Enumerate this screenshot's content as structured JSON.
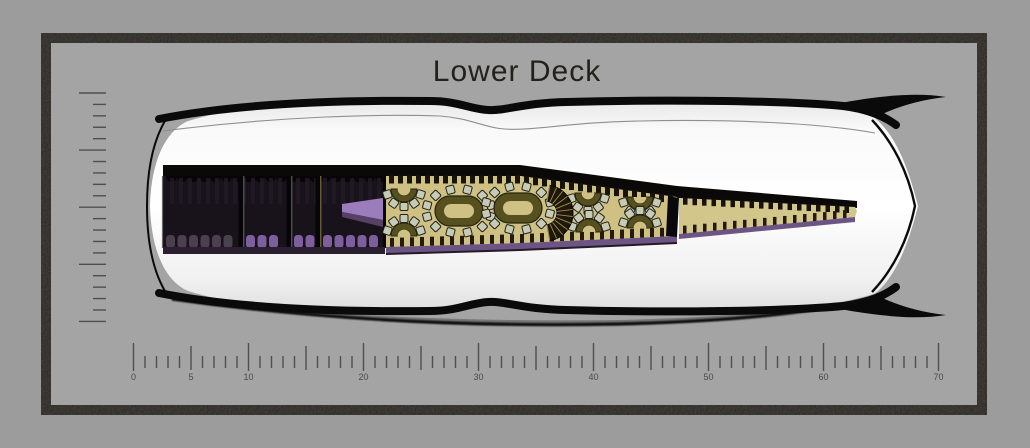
{
  "title": "Lower Deck",
  "colors": {
    "page_bg": "#9c9c9c",
    "mat_bg": "#a4a4a4",
    "frame": "#2b2724",
    "title_text": "#23211c",
    "ruler_tick": "#4f4f4f",
    "ruler_label": "#4a4a4a",
    "hull_edge": "#0a0a0a",
    "crease": "#8f8f8f",
    "hull_shadow": "#4a4a4a",
    "interior_dark": "#18121b",
    "interior_border": "#0b0908",
    "wall": "#060507",
    "wall_accent": "#8d8544",
    "wall_edge_light": "#6a6a6a",
    "floor_tan": "#cfc183",
    "floor_tan_bow": "#d2c68a",
    "tooth_dark": "#17120a",
    "rib_dark": "#241a10",
    "curtain_streak": "#231a26",
    "scallop_dark": "#070508",
    "seat_gray": "#4a4050",
    "seat_purple": "#7d5f9e",
    "band_purple": "#6d5583",
    "under_shadow": "#241a29",
    "rooms_underline": "#2a2030",
    "wedge_purple": "#9b7cbc",
    "wedge_shadow": "#573f66",
    "table_ring": "#55501e",
    "table_edge": "#26230e",
    "table_center": "#cfc183",
    "chair": "#c6cbb5",
    "chair_edge": "#23211a",
    "fan_dark": "#1f1806",
    "fan_spoke": "#c5b572",
    "bulkhead": "#0a080c"
  },
  "rulers": {
    "horizontal": {
      "min": 0,
      "max": 70,
      "origin_x": 133.5,
      "px_per_unit": 11.5,
      "minor_step": 1,
      "medium_step": 5,
      "major_step": 10,
      "labels": [
        {
          "unit": 0,
          "text": "0"
        },
        {
          "unit": 5,
          "text": "5"
        },
        {
          "unit": 10,
          "text": "10"
        },
        {
          "unit": 20,
          "text": "20"
        },
        {
          "unit": 30,
          "text": "30"
        },
        {
          "unit": 40,
          "text": "40"
        },
        {
          "unit": 50,
          "text": "50"
        },
        {
          "unit": 60,
          "text": "60"
        },
        {
          "unit": 70,
          "text": "70"
        }
      ]
    },
    "vertical": {
      "ticks": 21,
      "major_every": 5,
      "x_right": 106,
      "major_len": 27,
      "minor_len": 13,
      "y_top": 93,
      "step": 11.42
    }
  },
  "deck_plan": {
    "rooms": {
      "bounds": [
        163,
        176,
        385,
        248
      ],
      "dividers_x": [
        241,
        289,
        318
      ],
      "seat_rows": [
        {
          "x1": 166,
          "x2": 237,
          "color_key": "seat_gray"
        },
        {
          "x1": 246,
          "x2": 286,
          "color_key": "seat_purple"
        },
        {
          "x1": 294,
          "x2": 315,
          "color_key": "seat_purple"
        },
        {
          "x1": 323,
          "x2": 381,
          "color_key": "seat_purple"
        }
      ],
      "stair_wedge": {
        "x1": 342,
        "x2": 383,
        "top1": 204,
        "top2": 198,
        "bot1": 212,
        "bot2": 220
      }
    },
    "salon": {
      "top_edge": [
        [
          386,
          176
        ],
        [
          520,
          176
        ],
        [
          677,
          197
        ]
      ],
      "bottom_edge": [
        [
          386,
          247
        ],
        [
          520,
          243
        ],
        [
          677,
          236
        ]
      ],
      "oval_tables": [
        {
          "cx": 459,
          "cy": 211,
          "chairs": 12
        },
        {
          "cx": 518,
          "cy": 208,
          "chairs": 12
        }
      ],
      "semi_tables": [
        {
          "cx": 404,
          "cy": 189,
          "dir": 1,
          "chairs": 5
        },
        {
          "cx": 588,
          "cy": 193,
          "dir": 1,
          "chairs": 5
        },
        {
          "cx": 640,
          "cy": 197,
          "dir": 1,
          "chairs": 5
        },
        {
          "cx": 404,
          "cy": 236,
          "dir": -1,
          "chairs": 5
        },
        {
          "cx": 589,
          "cy": 232,
          "dir": -1,
          "chairs": 5
        },
        {
          "cx": 640,
          "cy": 228,
          "dir": -1,
          "chairs": 5
        }
      ],
      "stair_fan": {
        "cx": 545,
        "cy": 213,
        "r_out": 28,
        "r_in": 12,
        "a0": -80,
        "a1": 80,
        "spokes": 11
      }
    },
    "bow": {
      "top_edge": [
        [
          679,
          198
        ],
        [
          855,
          207
        ]
      ],
      "bottom_edge": [
        [
          679,
          234
        ],
        [
          855,
          217
        ]
      ],
      "tip_x": 857
    }
  }
}
